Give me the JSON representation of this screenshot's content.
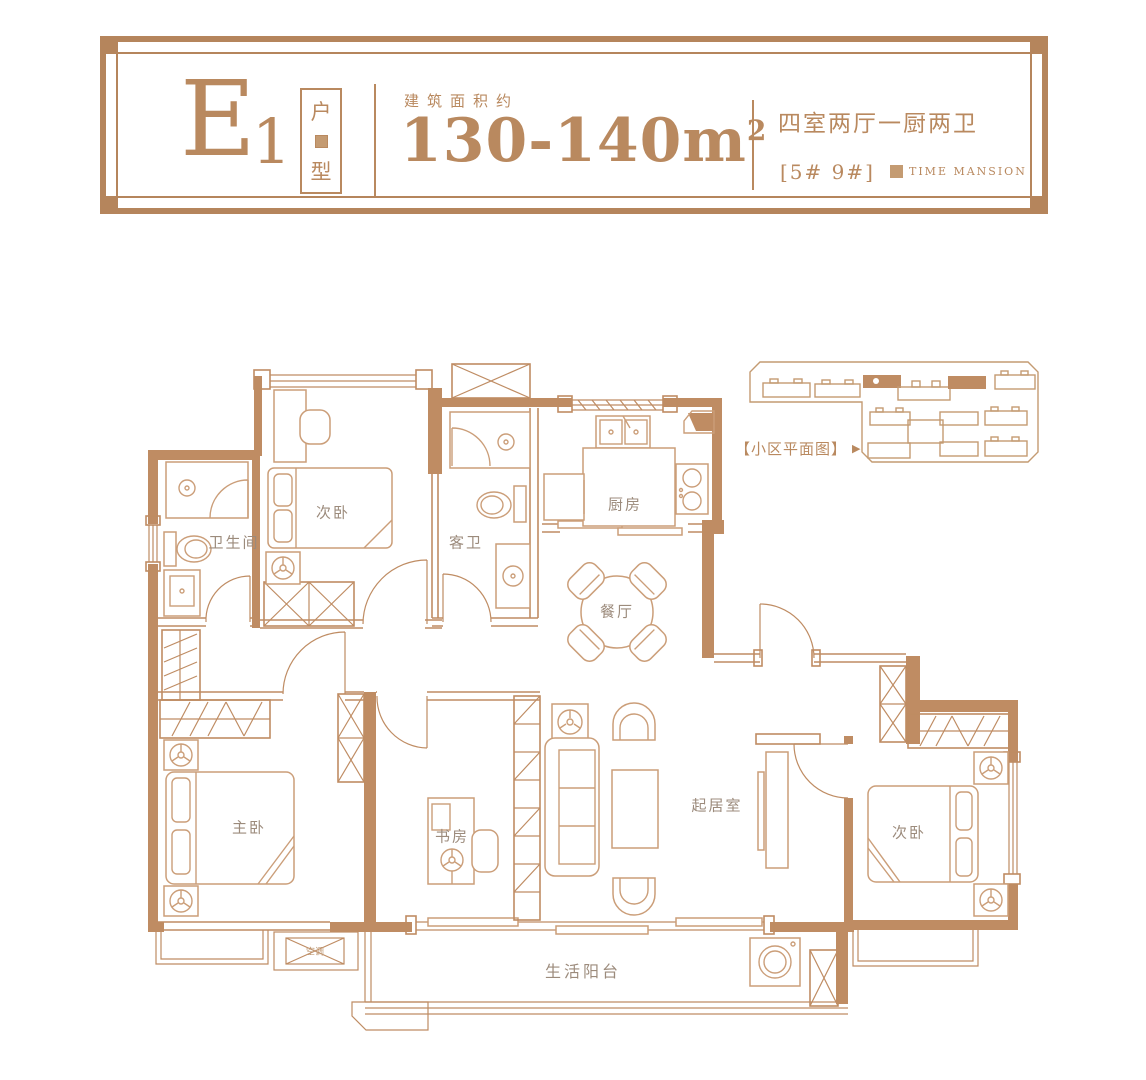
{
  "header": {
    "unit_letter": "E",
    "unit_number": "1",
    "unit_type_top": "户",
    "unit_type_bottom": "型",
    "area_label": "建筑面积约",
    "area_value": "130-140m",
    "area_exponent": "2",
    "layout_summary": "四室两厅一厨两卫",
    "building_numbers": "[5# 9#]",
    "brand_name": "TIME MANSION"
  },
  "site_plan": {
    "label": "【小区平面图】",
    "arrow": "▶"
  },
  "rooms": {
    "bathroom": "卫生间",
    "bedroom_top": "次卧",
    "guest_bathroom": "客卫",
    "kitchen": "厨房",
    "dining_room": "餐厅",
    "master_bedroom": "主卧",
    "study": "书房",
    "living_room": "起居室",
    "bedroom_right": "次卧",
    "balcony": "生活阳台",
    "ac_unit": "空调"
  },
  "colors": {
    "wall": "#bf8c63",
    "furniture_line": "#cb9e79",
    "accent": "#b9895f",
    "label_text": "#9c8b7c"
  }
}
